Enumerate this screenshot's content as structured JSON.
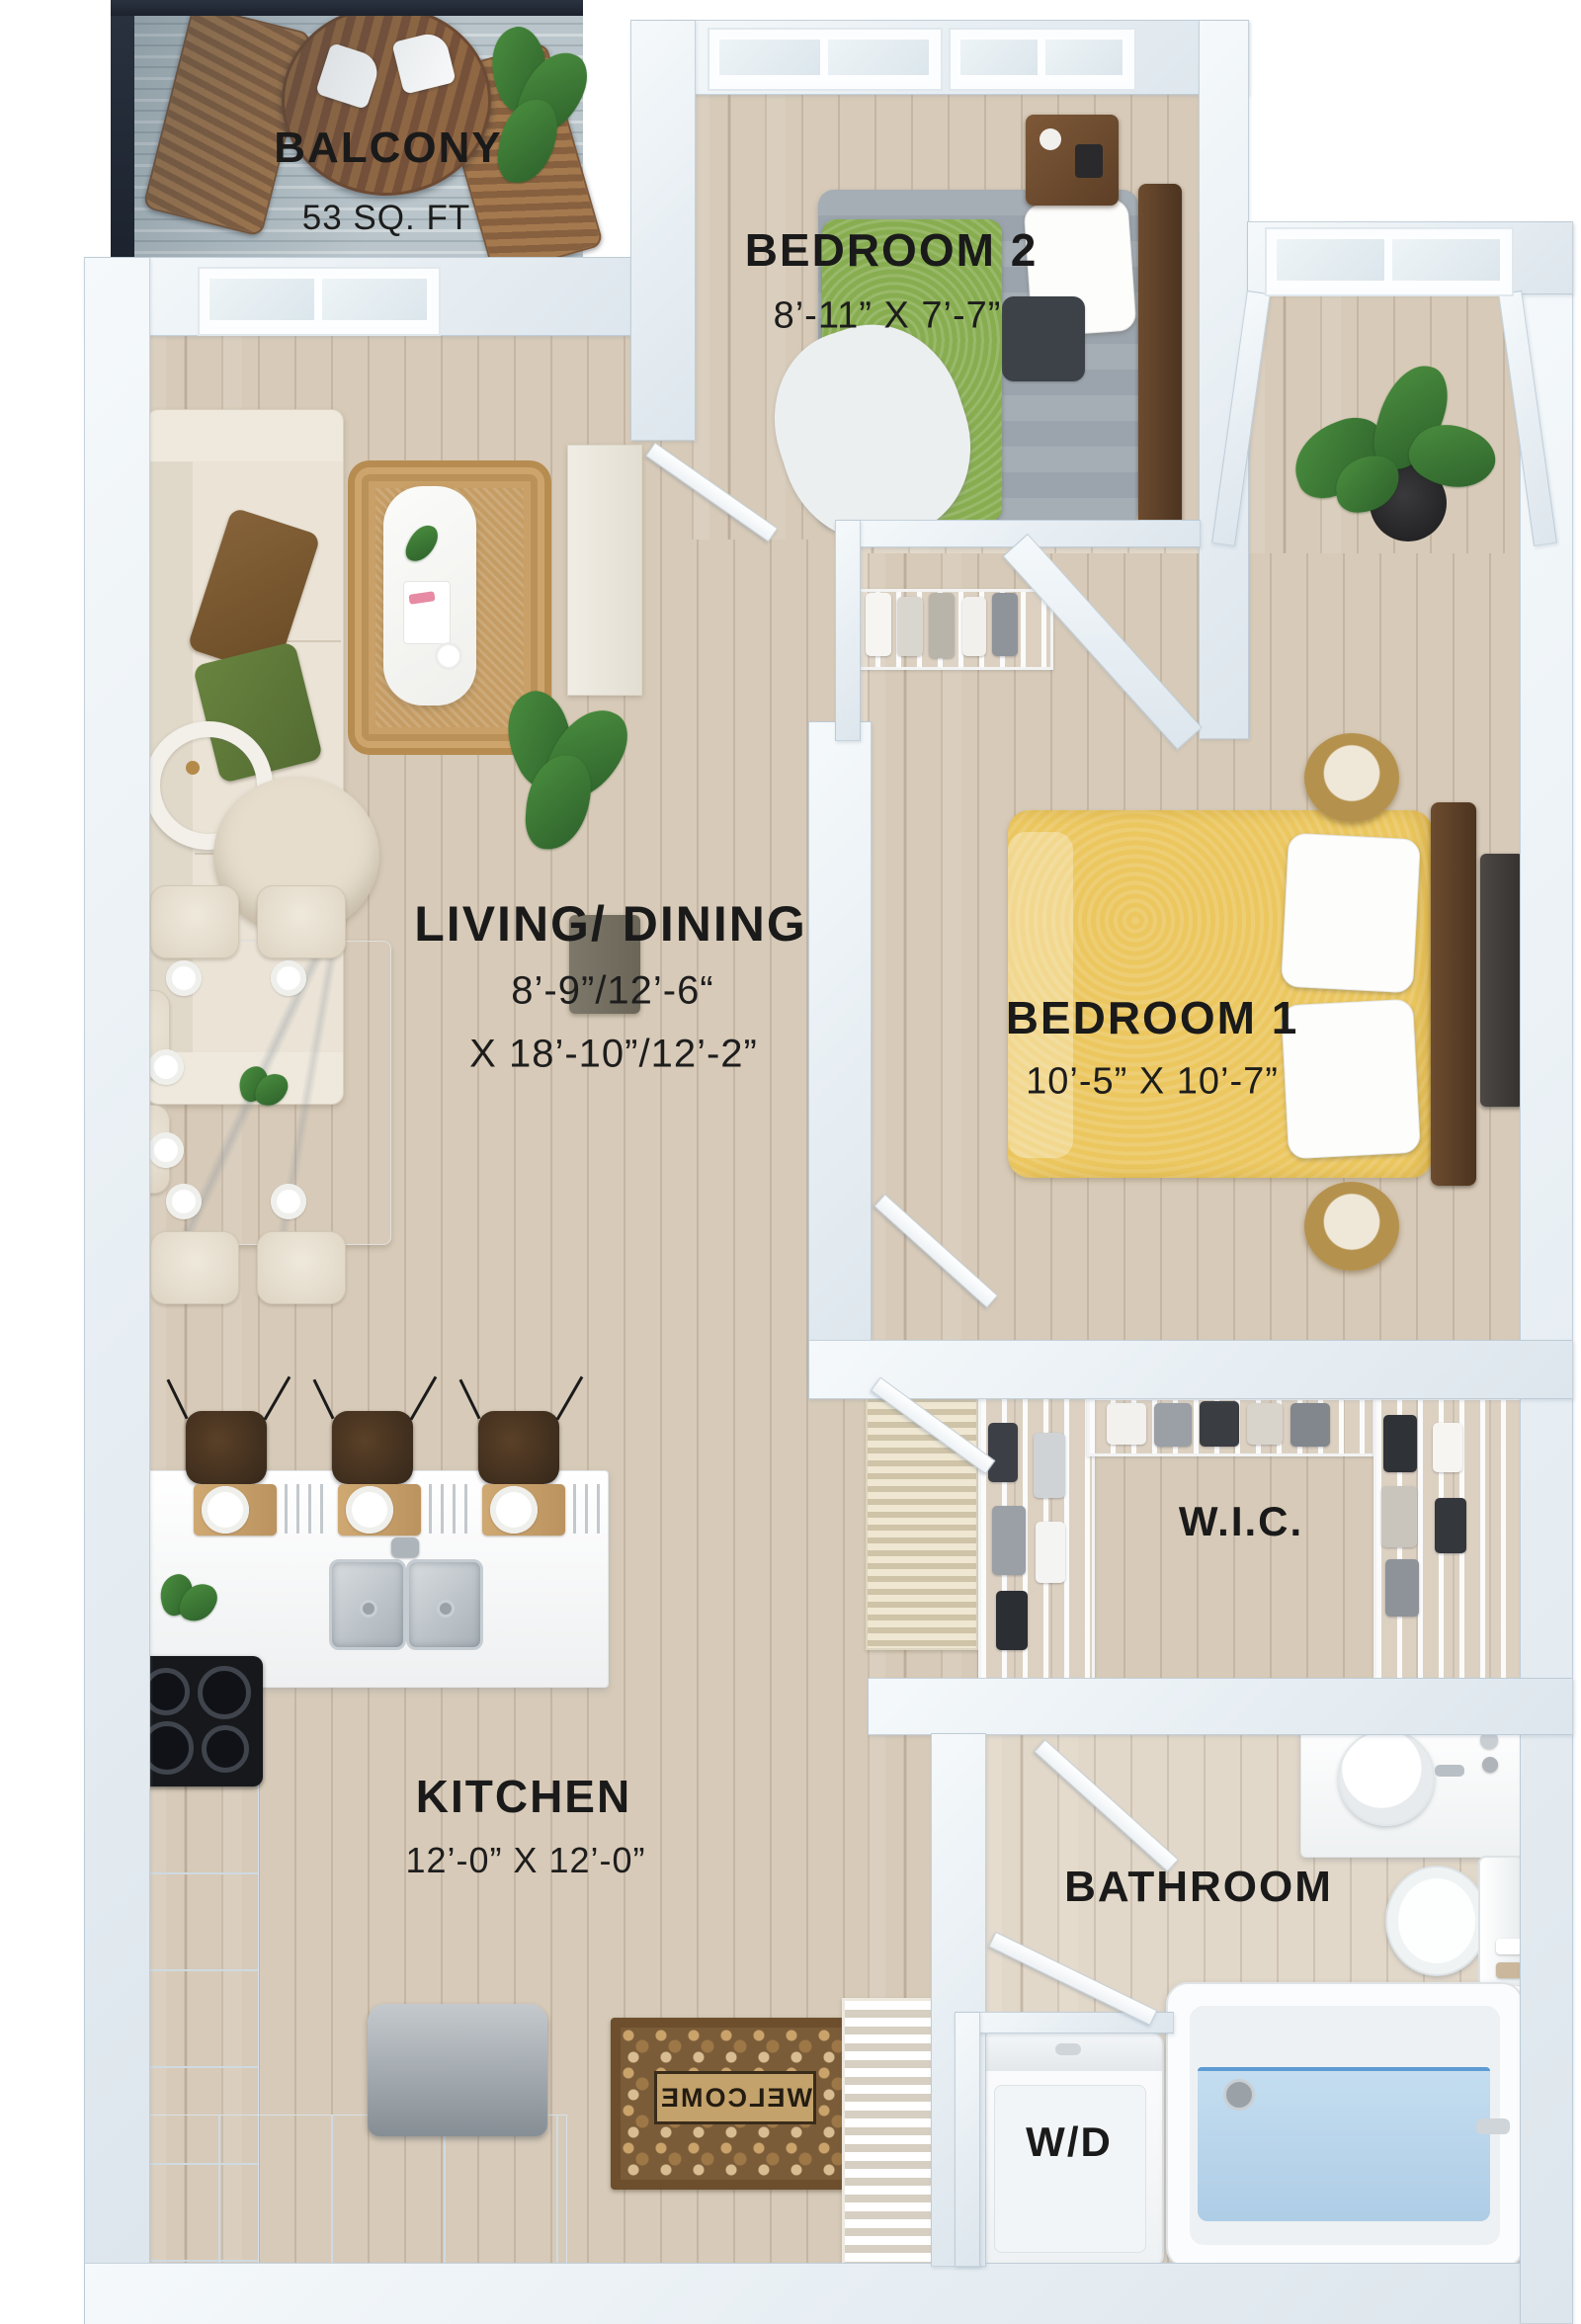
{
  "plan": {
    "type": "apartment-floor-plan",
    "balcony": {
      "label": "BALCONY",
      "area": "53 SQ. FT"
    },
    "bedroom2": {
      "label": "BEDROOM 2",
      "dims": "8’-11” X 7’-7”"
    },
    "living": {
      "label": "LIVING/ DINING",
      "dims_line1": "8’-9”/12’-6“",
      "dims_line2": "X 18’-10”/12’-2”"
    },
    "bedroom1": {
      "label": "BEDROOM 1",
      "dims": "10’-5” X 10’-7”"
    },
    "wic": {
      "label": "W.I.C."
    },
    "kitchen": {
      "label": "KITCHEN",
      "dims": "12’-0” X 12’-0”"
    },
    "bathroom": {
      "label": "BATHROOM"
    },
    "laundry": {
      "label": "W/D"
    },
    "doormat": {
      "label": "WELCOME"
    }
  },
  "colors": {
    "wall": "#e7eef3",
    "balcony_frame": "#1c232e",
    "floor_wood": "#d7cab8",
    "bed1_duvet": "#ecc75f",
    "bed2_duvet": "#9ba4ad",
    "bed2_throw": "#87ad50",
    "rug": "#c59c63",
    "water": "#aecde6",
    "label_text": "#1a1a1a"
  }
}
